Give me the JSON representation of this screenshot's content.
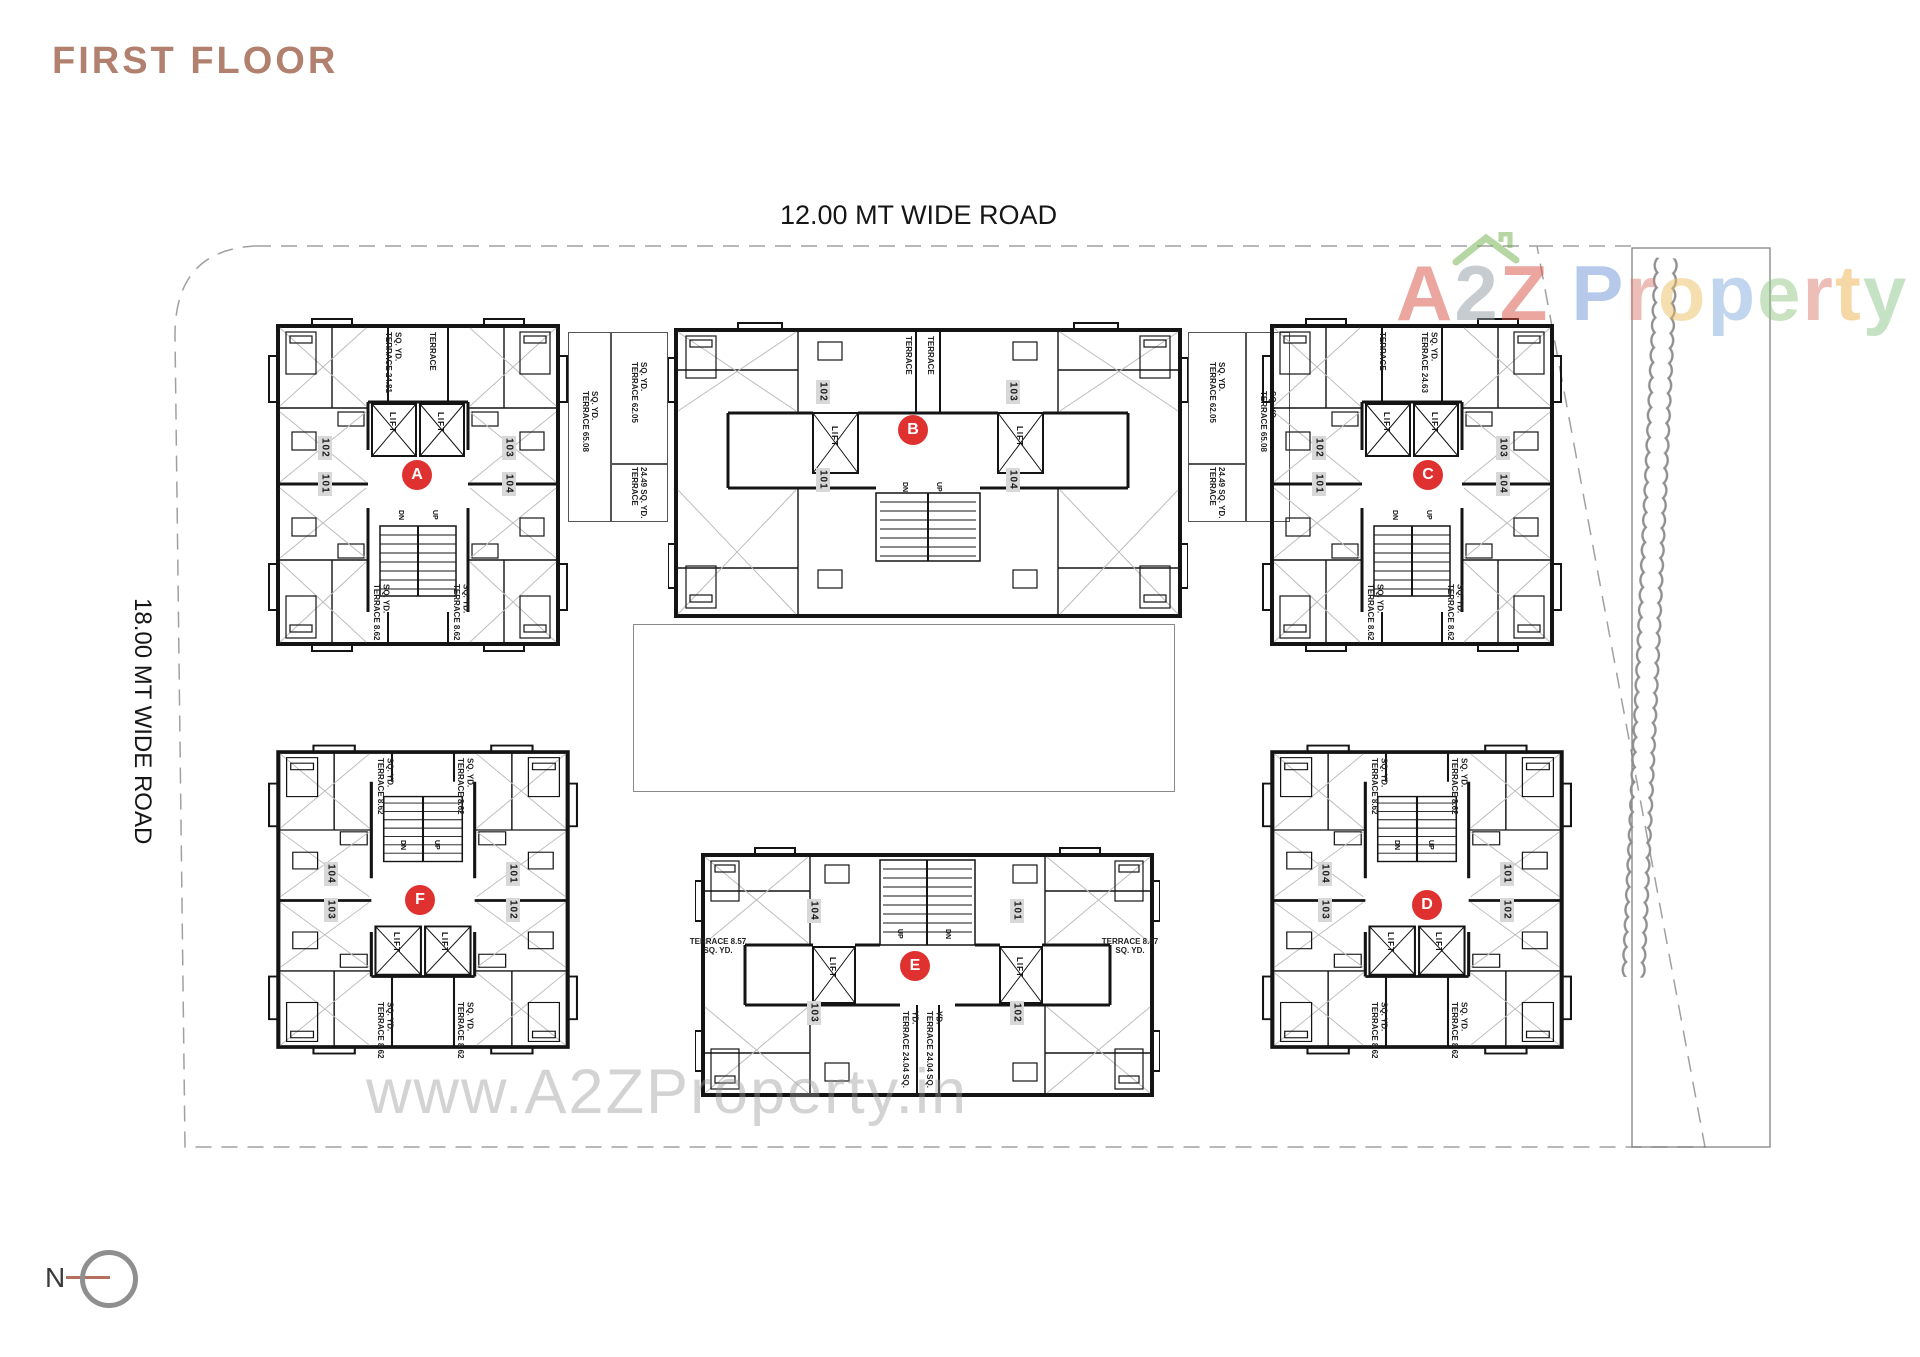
{
  "title": "FIRST FLOOR",
  "roads": {
    "top": "12.00 MT WIDE ROAD",
    "left": "18.00 MT WIDE ROAD"
  },
  "compass": {
    "label": "N"
  },
  "watermark": "www.A2ZProperty.in",
  "logo": {
    "a2z_letters": [
      "A",
      "2",
      "Z"
    ],
    "property_letters": [
      "P",
      "r",
      "o",
      "p",
      "e",
      "r",
      "t",
      "y"
    ],
    "colors": {
      "a": "#d94f43",
      "two": "#8f9aa3",
      "z": "#d94f43",
      "roof": "#6fae4a",
      "p1": "#6f95d6",
      "r1": "#dd7f72",
      "o": "#ecc063",
      "p2": "#84aede",
      "e": "#92c787",
      "r2": "#dd7f72",
      "t": "#eeb24f",
      "y": "#8cc98a"
    }
  },
  "labels": {
    "lift": "LIFT",
    "dn": "DN",
    "up": "UP"
  },
  "blocks": {
    "a": {
      "letter": "A",
      "units": [
        "102",
        "101",
        "103",
        "104"
      ],
      "terrace_top_left": "TERRACE 24.81 SQ. YD.",
      "terrace_top_right": "TERRACE",
      "terrace_bottom_left": "TERRACE 8.62 SQ. YD.",
      "terrace_bottom_right": "TERRACE 8.62 SQ. YD."
    },
    "b": {
      "letter": "B",
      "units": [
        "102",
        "101",
        "103",
        "104"
      ],
      "terrace_top_left": "TERRACE",
      "terrace_top_right": "TERRACE"
    },
    "c": {
      "letter": "C",
      "units": [
        "102",
        "101",
        "103",
        "104"
      ],
      "terrace_top_left": "TERRACE",
      "terrace_top_right": "TERRACE 24.63 SQ. YD.",
      "terrace_bottom_left": "TERRACE 8.62 SQ. YD.",
      "terrace_bottom_right": "TERRACE 8.62 SQ. YD."
    },
    "d": {
      "letter": "D",
      "units": [
        "104",
        "103",
        "101",
        "102"
      ],
      "terrace_top_left": "TERRACE 8.62 SQ. YD.",
      "terrace_top_right": "TERRACE 8.62 SQ. YD.",
      "terrace_bottom_left": "TERRACE 8.62 SQ. YD.",
      "terrace_bottom_right": "TERRACE 8.62 SQ. YD."
    },
    "e": {
      "letter": "E",
      "units": [
        "104",
        "103",
        "101",
        "102"
      ],
      "terrace_left": "TERRACE 8.57 SQ. YD.",
      "terrace_right": "TERRACE 8.57 SQ. YD.",
      "terrace_center_left": "TERRACE 24.04 SQ. YD.",
      "terrace_center_right": "TERRACE 24.04 SQ. YD."
    },
    "f": {
      "letter": "F",
      "units": [
        "104",
        "103",
        "101",
        "102"
      ],
      "terrace_top_left": "TERRACE 8.62 SQ. YD.",
      "terrace_top_right": "TERRACE 8.62 SQ. YD.",
      "terrace_bottom_left": "TERRACE 8.62 SQ. YD.",
      "terrace_bottom_right": "TERRACE 8.62 SQ. YD."
    }
  },
  "connectors": {
    "left": {
      "large": "TERRACE 65.08 SQ. YD.",
      "top": "TERRACE 62.05 SQ. YD.",
      "bottom": "TERRACE 24.49 SQ. YD."
    },
    "right": {
      "large": "TERRACE 65.08 SQ. YD.",
      "top": "TERRACE 62.05 SQ. YD.",
      "bottom": "TERRACE 24.49 SQ. YD."
    }
  },
  "colors": {
    "accent_red": "#e03131",
    "title_text": "#b1806e",
    "compass_line": "#b5705f",
    "boundary_dash": "#a0a0a0",
    "wall_ink": "#141414",
    "watermark_gray": "#969696"
  }
}
